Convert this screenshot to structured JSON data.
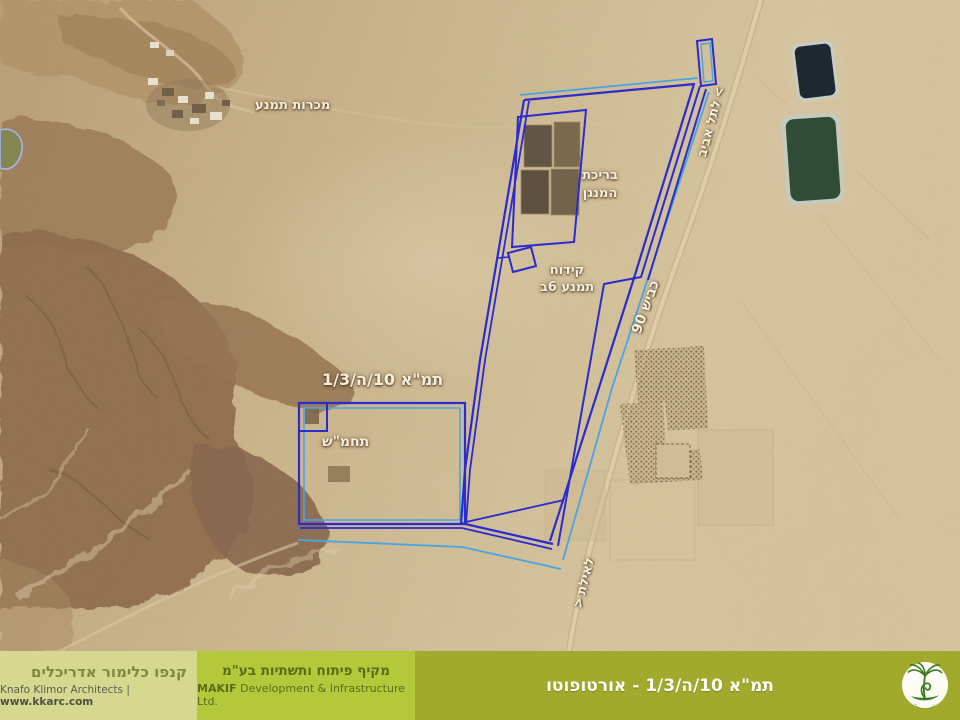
{
  "slide": {
    "map": {
      "labels": {
        "timna_mines": "מכרות תמנע",
        "manganese_pool_line1": "בריכת",
        "manganese_pool_line2": "המנגן",
        "drill_line1": "קידוח",
        "drill_line2": "תמנע 6ב",
        "plan_area": "תמ\"א 10/ה/1/3",
        "substation": "תחמ\"ש",
        "to_tel_aviv": "לתל אביב",
        "to_tel_aviv_arrow": ">",
        "road_90": "כביש 90",
        "to_eilat": "לאילת",
        "to_eilat_arrow": "<"
      },
      "colors": {
        "boundary_primary": "#2b2bcf",
        "boundary_secondary": "#4aa4e4"
      }
    },
    "footer": {
      "architect": {
        "name_he": "קנפו כלימור אדריכלים",
        "name_en": "Knafo Klimor Architects",
        "separator": "|",
        "website": "www.kkarc.com",
        "bg": "#d6d88f"
      },
      "developer": {
        "name_he": "מקיף  פיתוח ותשתיות בע\"מ",
        "name_en_bold": "MAKIF",
        "name_en_rest": "Development & Infrastructure Ltd.",
        "bg": "#b4c83c"
      },
      "title_section": {
        "title": "תמ\"א 10/ה/1/3 - אורטופוטו",
        "bg": "#a2aa2e",
        "logo": "tree-logo"
      }
    }
  }
}
